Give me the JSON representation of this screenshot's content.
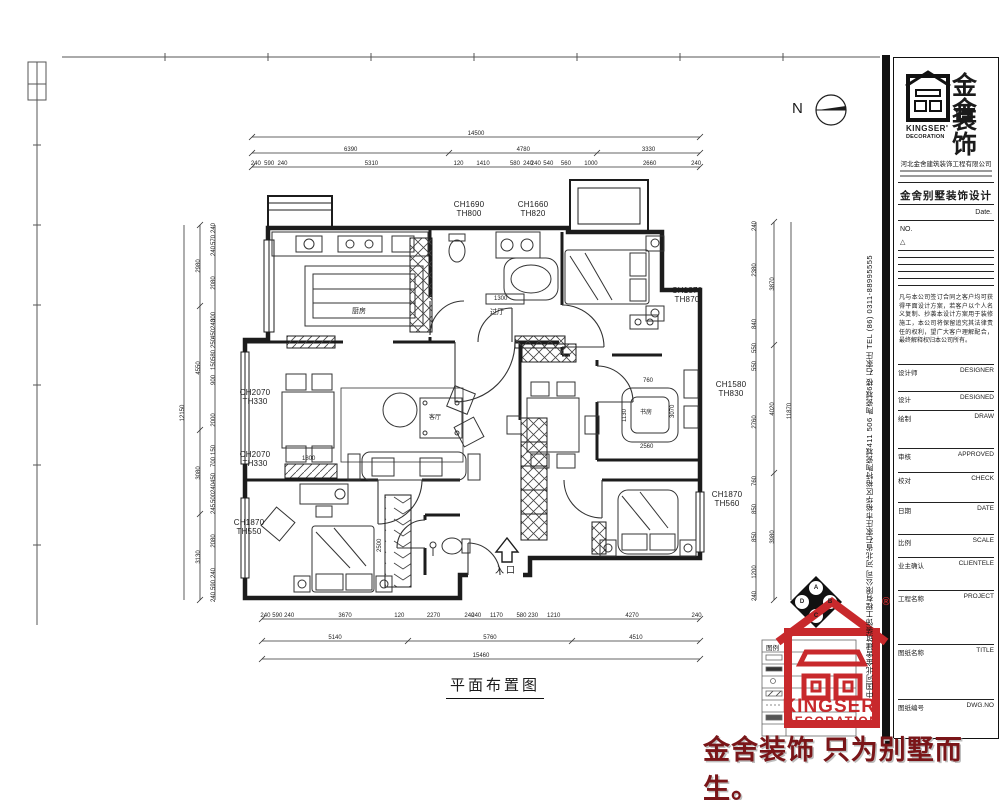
{
  "north_label": "N",
  "plan": {
    "title": "平面布置图",
    "entrance_label": "入口",
    "labels": {
      "bath_main": "CH1690\nTH800",
      "bath_main2": "CH1660\nTH820",
      "bed_tr": "CH1870\nTH870",
      "living_1": "CH2070\nTH330",
      "living_2": "CH2070\nTH330",
      "study": "CH1580\nTH830",
      "bed_br": "CH1870\nTH560",
      "bed_bl": "CH1870\nTH550"
    },
    "room_names": {
      "kitchen": "厨房",
      "hall": "过厅",
      "living": "客厅",
      "study": "书房"
    },
    "inline_dims": {
      "d1300": "1300",
      "d1800": "1800",
      "d760": "760",
      "d2560": "2560",
      "d1130": "1130",
      "d3070": "3070",
      "d2500": "2500"
    },
    "dims": {
      "top_total": [
        14500
      ],
      "top_segs": [
        6390,
        4780,
        3330
      ],
      "top_detail": [
        240,
        590,
        240,
        5310,
        120,
        1410,
        580,
        240,
        240,
        540,
        560,
        1000,
        2660,
        240
      ],
      "bottom_detail": [
        240,
        590,
        240,
        3670,
        120,
        2270,
        240,
        240,
        1170,
        580,
        230,
        1210,
        4270,
        240
      ],
      "bottom_segs": [
        5140,
        5760,
        4510
      ],
      "bottom_total": [
        15460
      ],
      "left_detail": [
        240,
        570,
        240,
        2080,
        300,
        240,
        450,
        250,
        580,
        150,
        900,
        2000,
        150,
        700,
        450,
        240,
        500,
        245,
        2080,
        240,
        590,
        240
      ],
      "left_segs": [
        2980,
        4550,
        3080,
        3130
      ],
      "left_total": [
        12150
      ],
      "right_detail": [
        240,
        2380,
        840,
        550,
        550,
        2760,
        760,
        850,
        850,
        1200,
        240
      ],
      "right_segs": [
        3870,
        4020,
        3980
      ],
      "right_total": [
        11870
      ]
    }
  },
  "title_block": {
    "brand_cn_1": "金舍",
    "brand_cn_2": "装饰",
    "brand_en_1": "KINGSER'",
    "brand_en_2": "DECORATION",
    "company": "河北金舍建筑装饰工程有限公司",
    "design_title": "金舍别墅装饰设计",
    "date_label": "Date.",
    "no_label": "NO.",
    "rev_mark": "△",
    "disclaimer": "凡与本公司签订合同之客户均可获得平面设计方案，若客户以个人名义复制、抄袭本设计方案用于装修施工，本公司将保留追究其法律责任的权利，望广大客户理解配合，最终解释权归本公司所有。",
    "rows": [
      {
        "cn": "设计师",
        "en": "DESIGNER"
      },
      {
        "cn": "设计",
        "en": "DESIGNED"
      },
      {
        "cn": "绘制",
        "en": "DRAW"
      },
      {
        "cn": "审核",
        "en": "APPROVED"
      },
      {
        "cn": "校对",
        "en": "CHECK"
      },
      {
        "cn": "日期",
        "en": "DATE"
      },
      {
        "cn": "比例",
        "en": "SCALE"
      },
      {
        "cn": "业主确认",
        "en": "CLIENTELE"
      },
      {
        "cn": "工程名称",
        "en": "PROJECT"
      },
      {
        "cn": "图纸名称",
        "en": "TITLE"
      },
      {
        "cn": "图纸编号",
        "en": "DWG.NO"
      }
    ]
  },
  "side_strip": {
    "address": "中国河北金舍建筑装饰工程有限公司  河北省石家庄市裕华区裕特陶瓷城411 506 陶瓷城6楼  石家庄  TEL (86) 0311-88995555"
  },
  "footer": {
    "slogan": "金舍装饰 只为别墅而生。",
    "legend_title": "图例",
    "reg_mark": "®",
    "logo_letters": {
      "a": "A",
      "b": "B",
      "c": "C",
      "d": "D"
    },
    "red_brand_1": "KINGSER'",
    "red_brand_2": "DECORATION"
  },
  "accent_colors": {
    "brand_red": "#c8292c",
    "slogan_red": "#7a1518",
    "ink": "#1b1b1b"
  }
}
